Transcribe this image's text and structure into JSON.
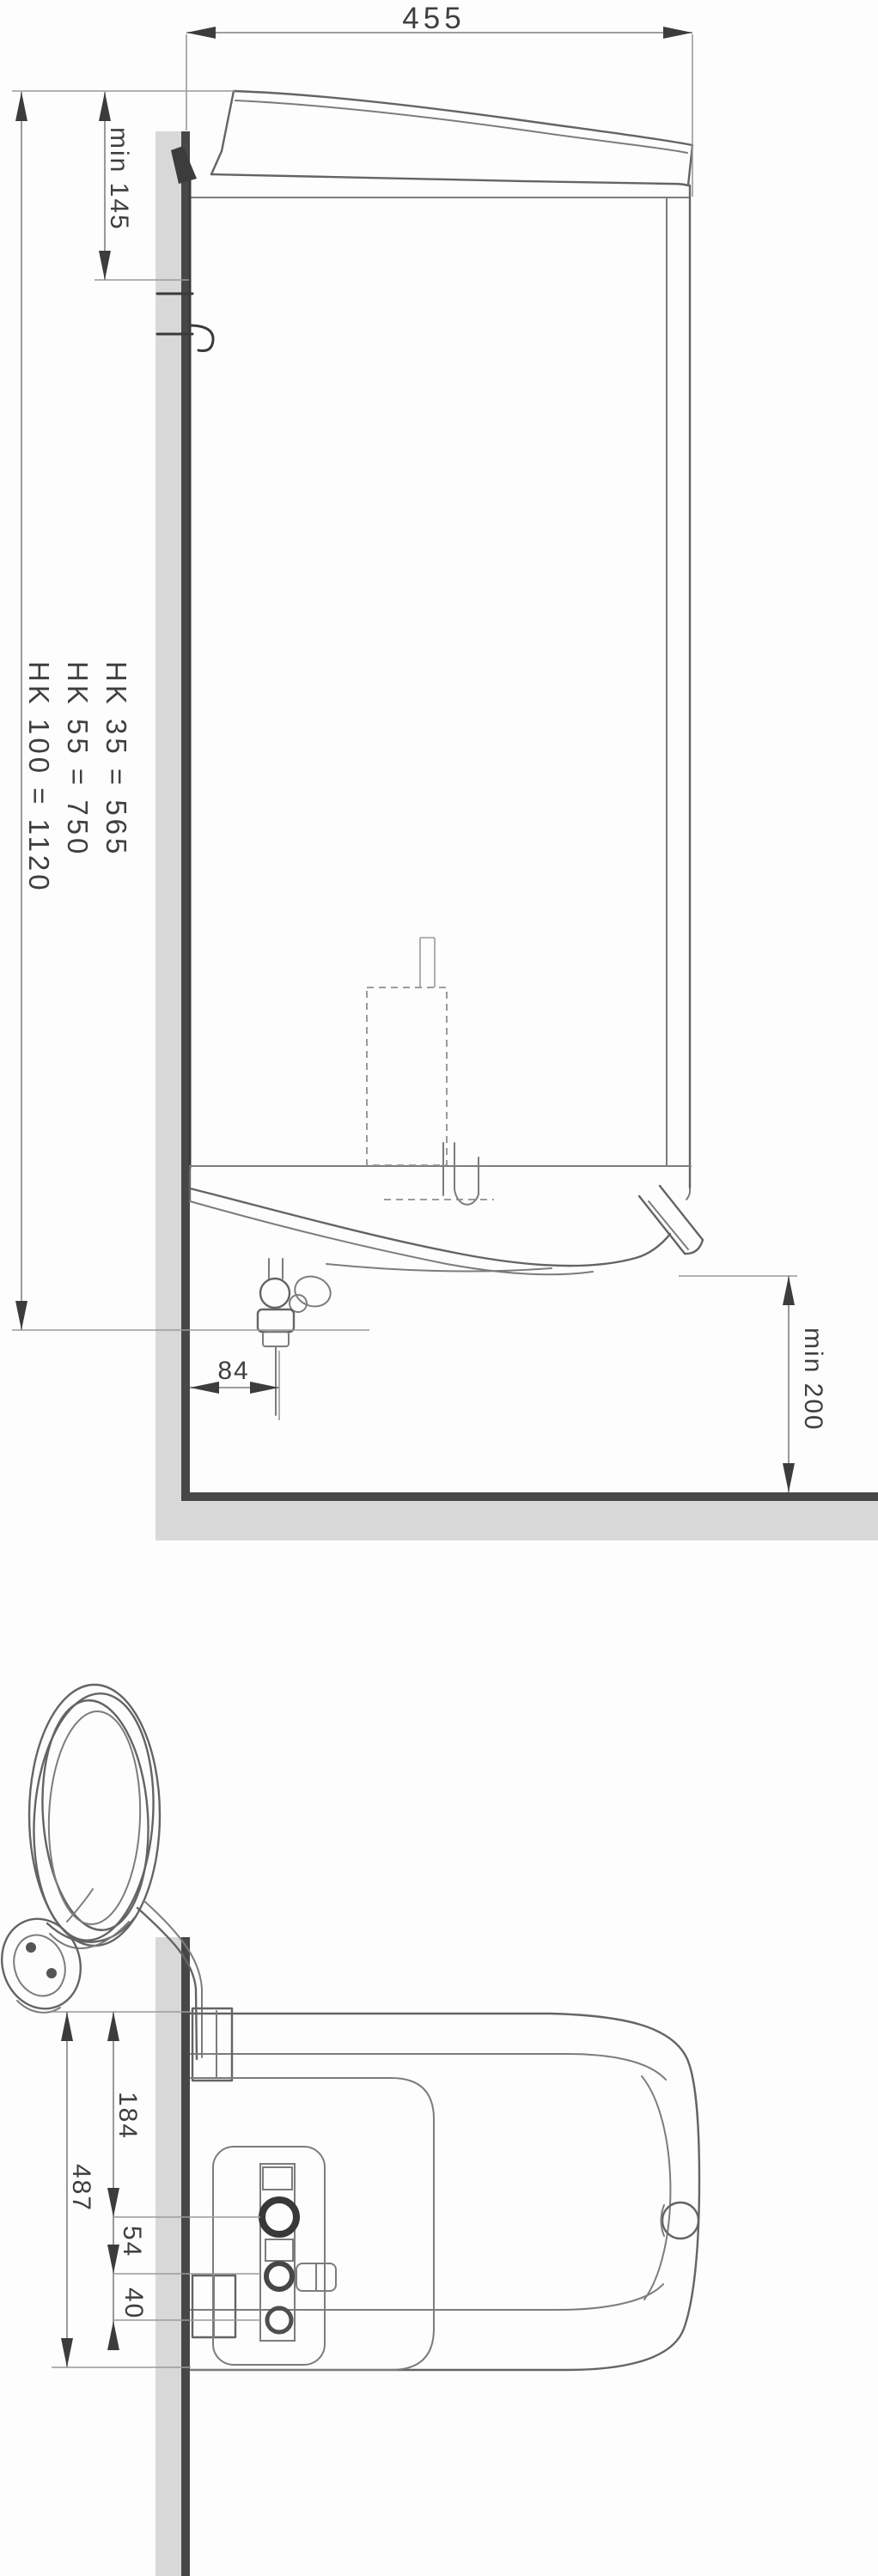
{
  "drawing": {
    "kind": "water-heater installation dimension drawing",
    "side_view": {
      "width": "455",
      "min_clearance_above": "min 145",
      "mounting_heights": [
        "HK  35 = 565",
        "HK  55 = 750",
        "HK 100 = 1120"
      ],
      "valve_wall_offset": "84",
      "min_clearance_below": "min 200"
    },
    "top_view": {
      "overall_depth": "487",
      "edge_to_first_connection": "184",
      "first_to_second_connection": "54",
      "second_to_third_connection": "40"
    }
  },
  "colors": {
    "background": "#fdfdfd",
    "line": "#646464",
    "wall_fill": "#d8d8d8",
    "wall_edge": "#474747",
    "text": "#3f3f3f"
  }
}
